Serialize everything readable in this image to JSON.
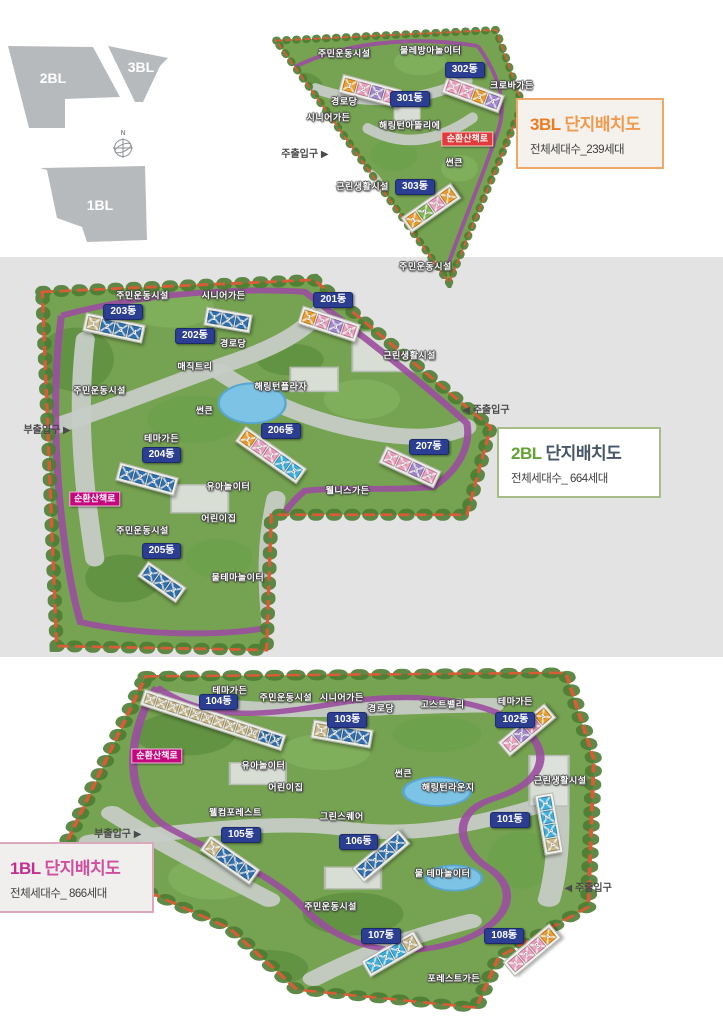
{
  "locator": {
    "compass_label": "N",
    "blocks": [
      {
        "id": "2bl",
        "label": "2BL"
      },
      {
        "id": "3bl",
        "label": "3BL"
      },
      {
        "id": "1bl",
        "label": "1BL"
      }
    ]
  },
  "plans": [
    {
      "id": "p3",
      "block": "3BL",
      "title": "단지배치도",
      "subtitle": "전체세대수_239세대",
      "accent": "#ee7b23",
      "accent2": "#f09a4e",
      "box_border": "#f0a868",
      "box_bg": "#f5f2ee",
      "loop_line": "#9b4ea0",
      "loop_badge": "#e03a3a",
      "labels": [
        {
          "t": "주민운동시설",
          "k": "fac",
          "x": 31,
          "y": 12
        },
        {
          "t": "물레방아놀이터",
          "k": "fac",
          "x": 64,
          "y": 11
        },
        {
          "t": "302동",
          "k": "dong",
          "x": 77,
          "y": 18
        },
        {
          "t": "크로바가든",
          "k": "fac",
          "x": 95,
          "y": 24
        },
        {
          "t": "경로당",
          "k": "fac",
          "x": 31,
          "y": 30
        },
        {
          "t": "301동",
          "k": "dong",
          "x": 56,
          "y": 29
        },
        {
          "t": "시니어가든",
          "k": "fac",
          "x": 25,
          "y": 36
        },
        {
          "t": "해링턴아뜰리에",
          "k": "fac",
          "x": 56,
          "y": 39
        },
        {
          "t": "순환산책로",
          "k": "loop",
          "x": 78,
          "y": 44
        },
        {
          "t": "주출입구 ▶",
          "k": "ent",
          "x": 16,
          "y": 50
        },
        {
          "t": "썬큰",
          "k": "fac",
          "x": 73,
          "y": 53
        },
        {
          "t": "근린생활시설",
          "k": "fac",
          "x": 38,
          "y": 62
        },
        {
          "t": "303동",
          "k": "dong",
          "x": 58,
          "y": 62
        },
        {
          "t": "주민운동시설",
          "k": "fac",
          "x": 62,
          "y": 92
        }
      ],
      "buildings": [
        {
          "id": "301",
          "x": 41,
          "y": 26,
          "rot": 15,
          "units": [
            {
              "n": "1",
              "c": "o"
            },
            {
              "n": "2",
              "c": "p"
            },
            {
              "n": "3",
              "c": "v"
            },
            {
              "n": "4",
              "c": "p"
            }
          ]
        },
        {
          "id": "302",
          "x": 80,
          "y": 27,
          "rot": 20,
          "units": [
            {
              "n": "1",
              "c": "p"
            },
            {
              "n": "2",
              "c": "p"
            },
            {
              "n": "3",
              "c": "o"
            },
            {
              "n": "4",
              "c": "v"
            }
          ]
        },
        {
          "id": "303",
          "x": 64,
          "y": 70,
          "rot": -35,
          "units": [
            {
              "n": "1",
              "c": "o"
            },
            {
              "n": "2",
              "c": "g"
            },
            {
              "n": "3",
              "c": "p"
            },
            {
              "n": "4",
              "c": "o"
            }
          ]
        }
      ]
    },
    {
      "id": "p2",
      "block": "2BL",
      "title": "단지배치도",
      "subtitle": "전체세대수_ 664세대",
      "accent": "#64a136",
      "accent2": "#475569",
      "box_border": "#a7bd88",
      "box_bg": "#ffffff",
      "loop_line": "#9b4ea0",
      "loop_badge": "#c5077e",
      "labels": [
        {
          "t": "주민운동시설",
          "k": "fac",
          "x": 24,
          "y": 9
        },
        {
          "t": "시니어가든",
          "k": "fac",
          "x": 41,
          "y": 9
        },
        {
          "t": "203동",
          "k": "dong",
          "x": 20,
          "y": 13
        },
        {
          "t": "201동",
          "k": "dong",
          "x": 64,
          "y": 10
        },
        {
          "t": "202동",
          "k": "dong",
          "x": 35,
          "y": 19
        },
        {
          "t": "경로당",
          "k": "fac",
          "x": 43,
          "y": 21
        },
        {
          "t": "근린생활시설",
          "k": "fac",
          "x": 80,
          "y": 24
        },
        {
          "t": "매직트리",
          "k": "fac",
          "x": 35,
          "y": 27
        },
        {
          "t": "해링턴플라자",
          "k": "fac",
          "x": 53,
          "y": 32
        },
        {
          "t": "주민운동시설",
          "k": "fac",
          "x": 15,
          "y": 33
        },
        {
          "t": "◀ 주출입구",
          "k": "ent",
          "x": 96,
          "y": 38
        },
        {
          "t": "썬큰",
          "k": "fac",
          "x": 37,
          "y": 38
        },
        {
          "t": "부출입구 ▶",
          "k": "ent",
          "x": 4,
          "y": 43
        },
        {
          "t": "테마가든",
          "k": "fac",
          "x": 28,
          "y": 45
        },
        {
          "t": "204동",
          "k": "dong",
          "x": 28,
          "y": 49
        },
        {
          "t": "206동",
          "k": "dong",
          "x": 53,
          "y": 43
        },
        {
          "t": "207동",
          "k": "dong",
          "x": 84,
          "y": 47
        },
        {
          "t": "순환산책로",
          "k": "loop",
          "x": 14,
          "y": 60
        },
        {
          "t": "유아놀이터",
          "k": "fac",
          "x": 42,
          "y": 57
        },
        {
          "t": "웰니스가든",
          "k": "fac",
          "x": 67,
          "y": 58
        },
        {
          "t": "어린이집",
          "k": "fac",
          "x": 40,
          "y": 65
        },
        {
          "t": "주민운동시설",
          "k": "fac",
          "x": 24,
          "y": 68
        },
        {
          "t": "205동",
          "k": "dong",
          "x": 28,
          "y": 73
        },
        {
          "t": "물테마놀이터",
          "k": "fac",
          "x": 44,
          "y": 80
        }
      ],
      "buildings": [
        {
          "id": "203",
          "x": 18,
          "y": 17,
          "rot": 12,
          "units": [
            {
              "n": "1",
              "c": "t"
            },
            {
              "n": "2",
              "c": "b"
            },
            {
              "n": "3",
              "c": "b"
            },
            {
              "n": "4",
              "c": "b"
            }
          ]
        },
        {
          "id": "202",
          "x": 42,
          "y": 15,
          "rot": 10,
          "units": [
            {
              "n": "1",
              "c": "b"
            },
            {
              "n": "2",
              "c": "b"
            },
            {
              "n": "3",
              "c": "b"
            }
          ]
        },
        {
          "id": "201",
          "x": 63,
          "y": 16,
          "rot": 18,
          "units": [
            {
              "n": "1",
              "c": "o"
            },
            {
              "n": "2",
              "c": "p"
            },
            {
              "n": "3",
              "c": "v"
            },
            {
              "n": "4",
              "c": "p"
            }
          ]
        },
        {
          "id": "204",
          "x": 25,
          "y": 55,
          "rot": 15,
          "units": [
            {
              "n": "1",
              "c": "b"
            },
            {
              "n": "2",
              "c": "b"
            },
            {
              "n": "3",
              "c": "b"
            },
            {
              "n": "4",
              "c": "b"
            }
          ]
        },
        {
          "id": "206",
          "x": 51,
          "y": 49,
          "rot": 35,
          "units": [
            {
              "n": "1",
              "c": "o"
            },
            {
              "n": "2",
              "c": "p"
            },
            {
              "n": "3",
              "c": "p"
            },
            {
              "n": "4",
              "c": "c"
            },
            {
              "n": "5",
              "c": "c"
            }
          ]
        },
        {
          "id": "207",
          "x": 80,
          "y": 52,
          "rot": 25,
          "units": [
            {
              "n": "1",
              "c": "p"
            },
            {
              "n": "2",
              "c": "p"
            },
            {
              "n": "3",
              "c": "v"
            },
            {
              "n": "4",
              "c": "p"
            }
          ]
        },
        {
          "id": "205",
          "x": 28,
          "y": 81,
          "rot": 35,
          "units": [
            {
              "n": "1",
              "c": "b"
            },
            {
              "n": "2",
              "c": "b"
            },
            {
              "n": "3",
              "c": "b"
            }
          ]
        }
      ]
    },
    {
      "id": "p1",
      "block": "1BL",
      "title": "단지배치도",
      "subtitle": "전체세대수_ 866세대",
      "accent": "#c2308e",
      "accent2": "#cf4ea0",
      "box_border": "#d9a8bd",
      "box_bg": "#f1efed",
      "loop_line": "#9b4ea0",
      "loop_badge": "#c5077e",
      "labels": [
        {
          "t": "테마가든",
          "k": "fac",
          "x": 33,
          "y": 8
        },
        {
          "t": "104동",
          "k": "dong",
          "x": 31,
          "y": 11
        },
        {
          "t": "주민운동시설",
          "k": "fac",
          "x": 43,
          "y": 10
        },
        {
          "t": "시니어가든",
          "k": "fac",
          "x": 53,
          "y": 10
        },
        {
          "t": "경로당",
          "k": "fac",
          "x": 60,
          "y": 13
        },
        {
          "t": "고스트밸리",
          "k": "fac",
          "x": 71,
          "y": 12
        },
        {
          "t": "테마가든",
          "k": "fac",
          "x": 84,
          "y": 11
        },
        {
          "t": "103동",
          "k": "dong",
          "x": 54,
          "y": 16
        },
        {
          "t": "102동",
          "k": "dong",
          "x": 84,
          "y": 16
        },
        {
          "t": "순환산책로",
          "k": "loop",
          "x": 20,
          "y": 26
        },
        {
          "t": "유아놀이터",
          "k": "fac",
          "x": 39,
          "y": 29
        },
        {
          "t": "어린이집",
          "k": "fac",
          "x": 43,
          "y": 35
        },
        {
          "t": "썬큰",
          "k": "fac",
          "x": 64,
          "y": 31
        },
        {
          "t": "해링턴라운지",
          "k": "fac",
          "x": 72,
          "y": 35
        },
        {
          "t": "근린생활시설",
          "k": "fac",
          "x": 92,
          "y": 33
        },
        {
          "t": "부출입구 ▶",
          "k": "ent",
          "x": 13,
          "y": 48
        },
        {
          "t": "웰컴포레스트",
          "k": "fac",
          "x": 34,
          "y": 42
        },
        {
          "t": "105동",
          "k": "dong",
          "x": 35,
          "y": 48
        },
        {
          "t": "그린스퀘어",
          "k": "fac",
          "x": 53,
          "y": 43
        },
        {
          "t": "106동",
          "k": "dong",
          "x": 56,
          "y": 50
        },
        {
          "t": "101동",
          "k": "dong",
          "x": 83,
          "y": 44
        },
        {
          "t": "주민운동시설",
          "k": "fac",
          "x": 51,
          "y": 68
        },
        {
          "t": "물 테마놀이터",
          "k": "fac",
          "x": 71,
          "y": 59
        },
        {
          "t": "◀ 주출입구",
          "k": "ent",
          "x": 97,
          "y": 63
        },
        {
          "t": "108동",
          "k": "dong",
          "x": 82,
          "y": 76
        },
        {
          "t": "107동",
          "k": "dong",
          "x": 60,
          "y": 76
        },
        {
          "t": "포레스트가든",
          "k": "fac",
          "x": 73,
          "y": 88
        }
      ],
      "buildings": [
        {
          "id": "104",
          "x": 30,
          "y": 16,
          "rot": 18,
          "s": 11,
          "units": [
            {
              "n": "1",
              "c": "t"
            },
            {
              "n": "2",
              "c": "t"
            },
            {
              "n": "3",
              "c": "t"
            },
            {
              "n": "4",
              "c": "t"
            },
            {
              "n": "5",
              "c": "t"
            },
            {
              "n": "6",
              "c": "t"
            },
            {
              "n": "7",
              "c": "t"
            },
            {
              "n": "8",
              "c": "t"
            },
            {
              "n": "9",
              "c": "t"
            },
            {
              "n": "10",
              "c": "t"
            },
            {
              "n": "11",
              "c": "b"
            },
            {
              "n": "12",
              "c": "b"
            }
          ]
        },
        {
          "id": "103",
          "x": 53,
          "y": 20,
          "rot": 10,
          "units": [
            {
              "n": "1",
              "c": "t"
            },
            {
              "n": "2",
              "c": "b"
            },
            {
              "n": "3",
              "c": "b"
            },
            {
              "n": "4",
              "c": "b"
            }
          ]
        },
        {
          "id": "102",
          "x": 86,
          "y": 19,
          "rot": -40,
          "units": [
            {
              "n": "1",
              "c": "p"
            },
            {
              "n": "2",
              "c": "v"
            },
            {
              "n": "3",
              "c": "p"
            },
            {
              "n": "4",
              "c": "o"
            }
          ]
        },
        {
          "id": "101",
          "x": 90,
          "y": 45,
          "rot": 80,
          "units": [
            {
              "n": "1",
              "c": "c"
            },
            {
              "n": "2",
              "c": "c"
            },
            {
              "n": "3",
              "c": "c"
            },
            {
              "n": "4",
              "c": "t"
            }
          ]
        },
        {
          "id": "105",
          "x": 33,
          "y": 55,
          "rot": 35,
          "units": [
            {
              "n": "1",
              "c": "t"
            },
            {
              "n": "2",
              "c": "b"
            },
            {
              "n": "3",
              "c": "b"
            },
            {
              "n": "4",
              "c": "b"
            }
          ]
        },
        {
          "id": "106",
          "x": 60,
          "y": 54,
          "rot": -40,
          "units": [
            {
              "n": "1",
              "c": "b"
            },
            {
              "n": "2",
              "c": "b"
            },
            {
              "n": "3",
              "c": "b"
            },
            {
              "n": "4",
              "c": "b"
            }
          ]
        },
        {
          "id": "107",
          "x": 62,
          "y": 81,
          "rot": -30,
          "units": [
            {
              "n": "1",
              "c": "c"
            },
            {
              "n": "2",
              "c": "c"
            },
            {
              "n": "3",
              "c": "c"
            },
            {
              "n": "4",
              "c": "t"
            }
          ]
        },
        {
          "id": "108",
          "x": 87,
          "y": 80,
          "rot": -40,
          "units": [
            {
              "n": "1",
              "c": "p"
            },
            {
              "n": "2",
              "c": "p"
            },
            {
              "n": "3",
              "c": "p"
            },
            {
              "n": "4",
              "c": "o"
            }
          ]
        }
      ]
    }
  ]
}
